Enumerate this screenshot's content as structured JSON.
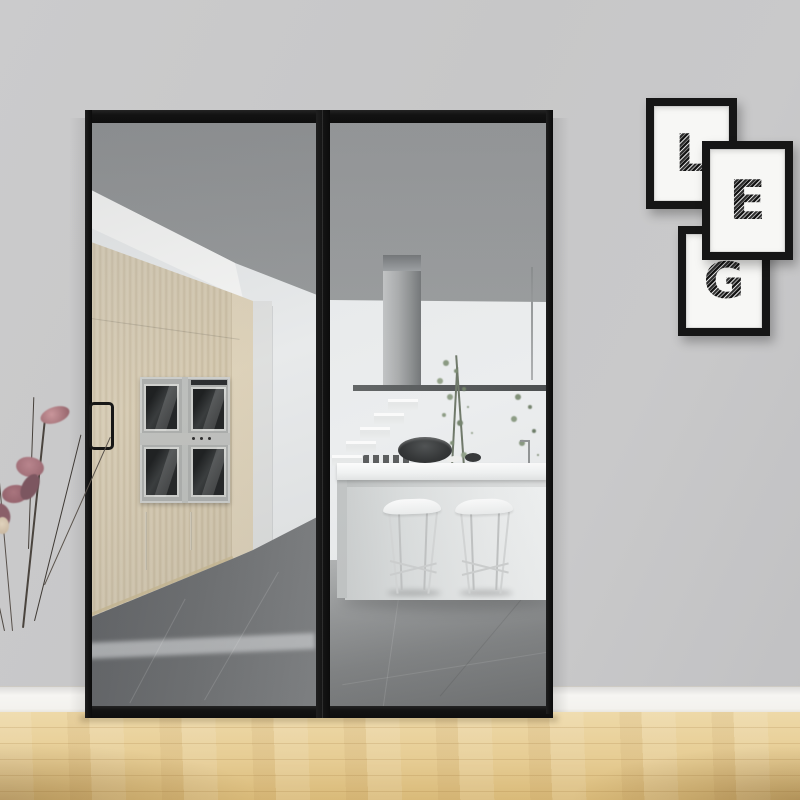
{
  "scene": {
    "type": "interior photograph",
    "description": "Black framed glass sliding partition doors revealing a modern kitchen with slatted wood cabinetry, built-in ovens, a white island with two bar stools, a chimney range hood and plants; three black letter-art frames on the right wall; dried flowers at the lower left; light oak floor in the foreground.",
    "door_panels": 2,
    "oven_doors": 4,
    "bar_stools": 2,
    "wall_letter_frames": [
      {
        "letter": "L"
      },
      {
        "letter": "E"
      },
      {
        "letter": "G"
      }
    ],
    "palette": {
      "wall": "#c7c7c8",
      "baseboard": "#f4f3f0",
      "door_frame": "#151515",
      "cabinet_wood": "#d6c9ae",
      "kitchen_tile": "#77797a",
      "island": "#eceeee",
      "wood_floor": "#e7cf9a",
      "flowers": "#a8757e",
      "foliage": "#82927a"
    }
  }
}
